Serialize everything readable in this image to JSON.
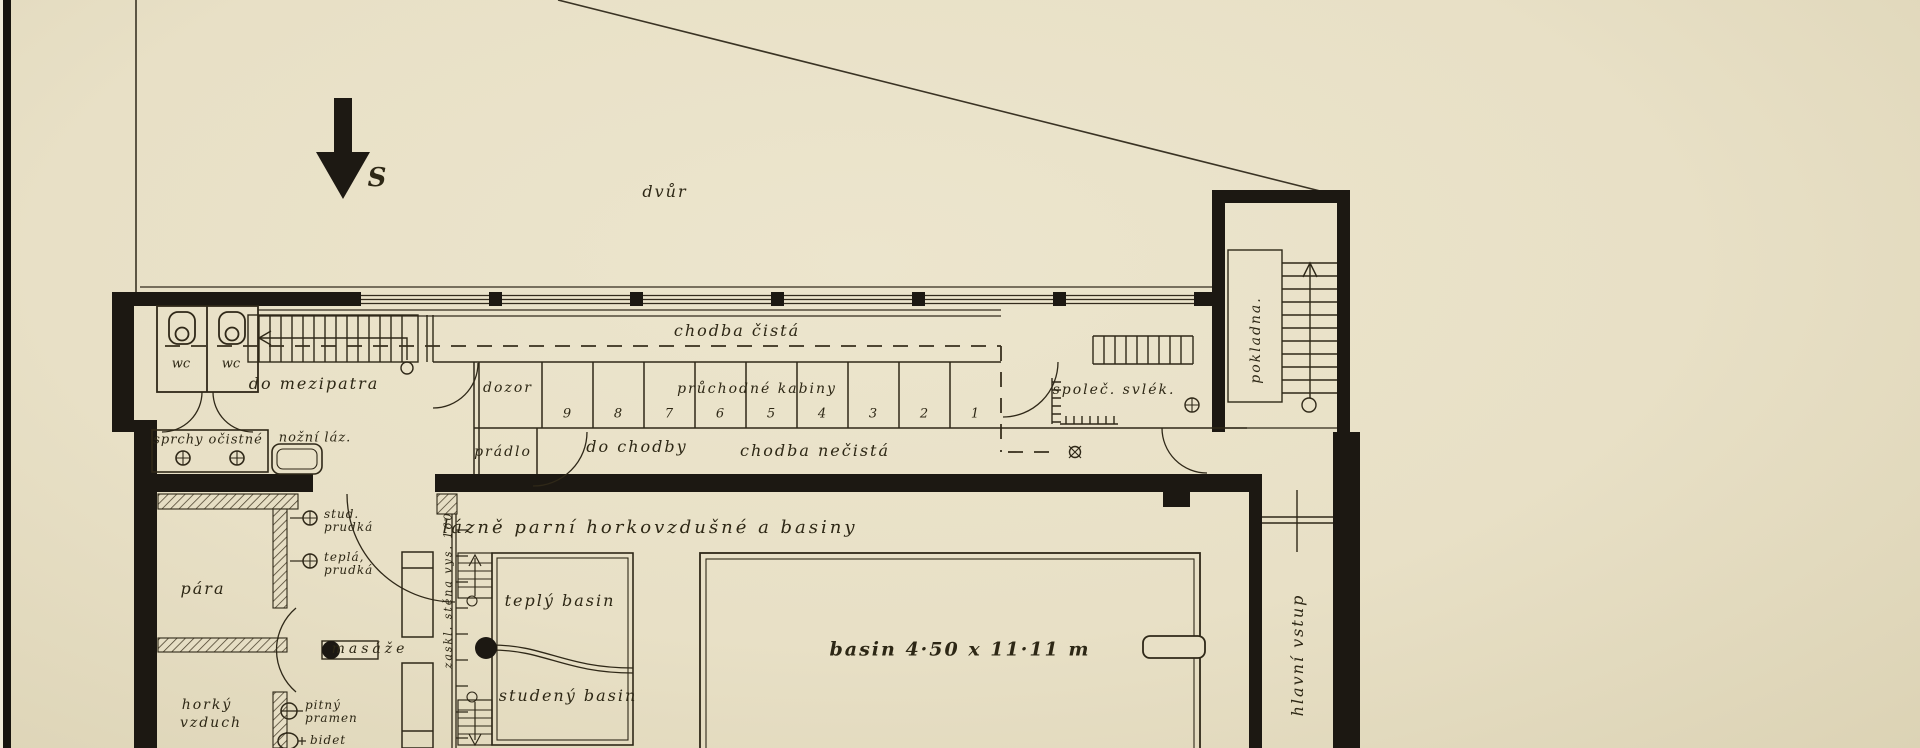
{
  "colors": {
    "paper": "#e8e0c6",
    "ink": "#332b1d",
    "wall": "#1c1812"
  },
  "compass": {
    "south_label": "S"
  },
  "site": {
    "courtyard": "dvůr"
  },
  "upper": {
    "wc_left": "wc",
    "wc_right": "wc",
    "do_mezipatra": "do mezipatra",
    "chodba_cista": "chodba čistá",
    "dozor": "dozor",
    "pruchodne_kabiny": "průchodné kabiny",
    "cabins": [
      "9",
      "8",
      "7",
      "6",
      "5",
      "4",
      "3",
      "2",
      "1"
    ],
    "spolec_svlek": "společ. svlék.",
    "pokladna": "pokladna.",
    "pradlo": "prádlo",
    "do_chodby": "do chodby",
    "chodba_necista": "chodba nečistá"
  },
  "baths": {
    "sprchy_ocistne": "sprchy očistné",
    "nozni_laz": "nožní láz.",
    "para": "pára",
    "stud_line1": "stud.",
    "stud_line2": "prudká",
    "tepla_line1": "teplá,",
    "tepla_line2": "prudká",
    "masaze": "masáže",
    "zaskl_stena": "zaskl. stěna vys. 160",
    "hall_title": "lázně parní horkovzdušné a basiny",
    "teply_basin": "teplý basin",
    "studeny_basin": "studený basin",
    "basin_dim": "basin 4·50 x 11·11 m",
    "pitny_line1": "pitný",
    "pitny_line2": "pramen",
    "bidet": "bidet",
    "horky_line1": "horký",
    "horky_line2": "vzduch",
    "hlavni_vstup": "hlavní vstup"
  }
}
